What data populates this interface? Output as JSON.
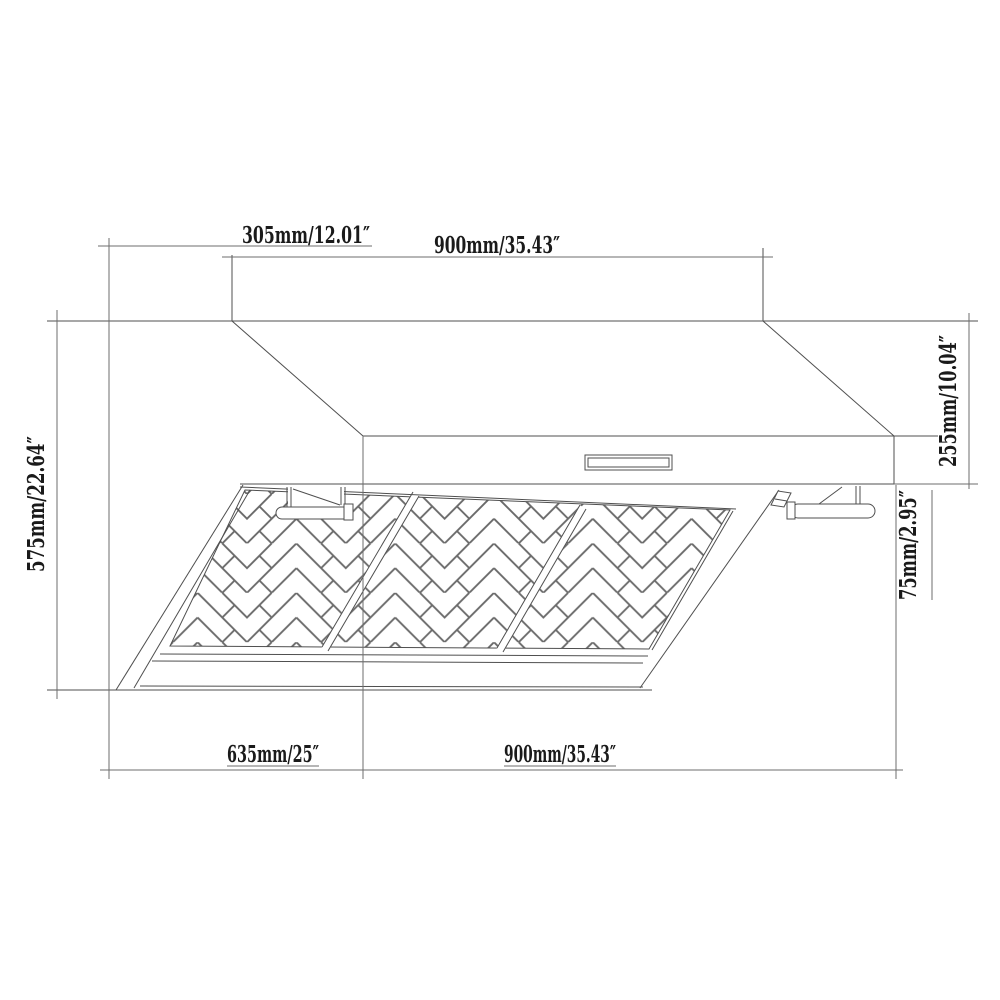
{
  "diagram": {
    "type": "range-hood-dimension-drawing",
    "labels": {
      "duct_offset": "305mm/12.01″",
      "top_width": "900mm/35.43″",
      "body_height": "255mm/10.04″",
      "total_height": "575mm/22.64″",
      "filter_height": "75mm/2.95″",
      "depth": "635mm/25″",
      "bottom_width": "900mm/35.43″"
    },
    "colors": {
      "line": "#4f4f4f",
      "dim_line": "#6e6e6e",
      "text": "#1a1a1a",
      "background": "#ffffff"
    }
  }
}
